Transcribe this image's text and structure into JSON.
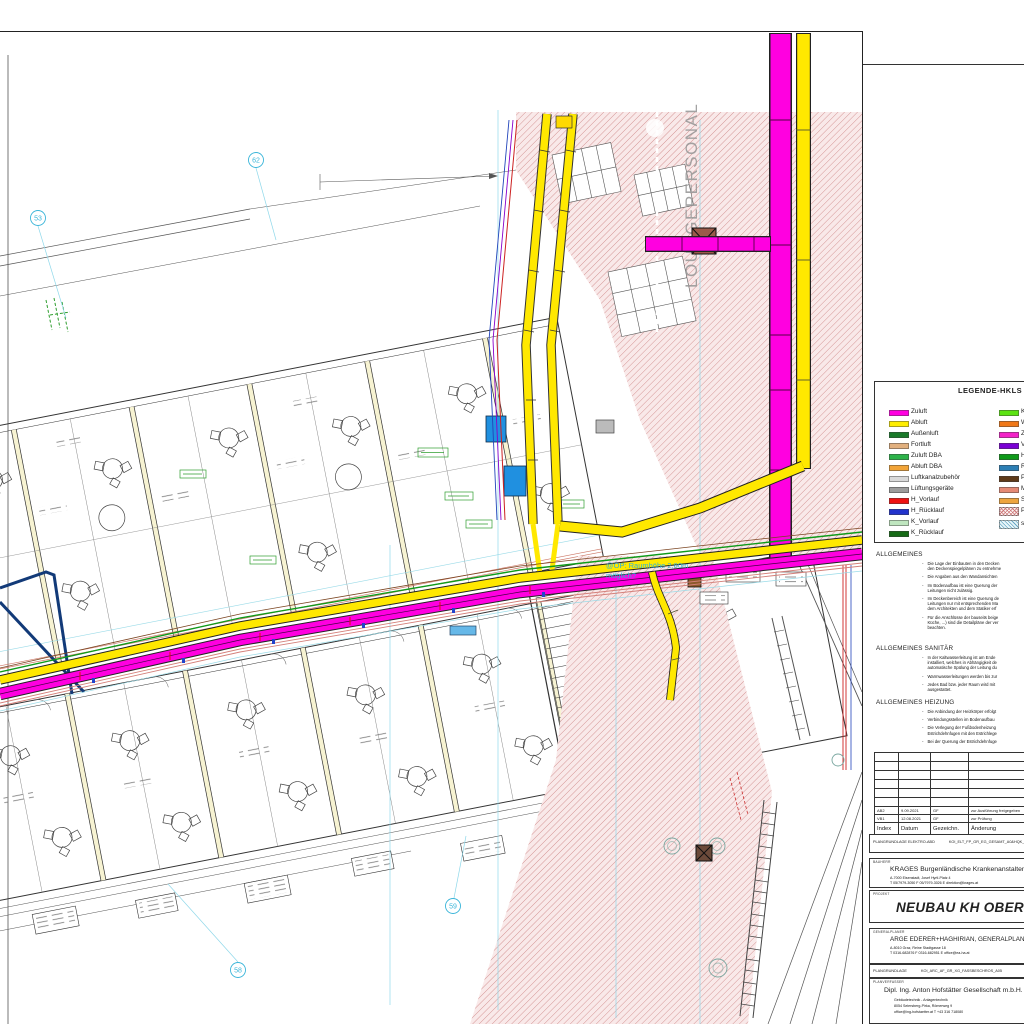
{
  "colors": {
    "zuluft_magenta": "#ff00e0",
    "abluft_yellow": "#ffe800",
    "hatch_pink": "#d29090",
    "grid_cyan": "#3ab5d9",
    "heizung_rot": "#cc2222",
    "ruecklauf_blau": "#2244bb",
    "navy": "#123a78"
  },
  "legend": {
    "title": "LEGENDE-HKLS",
    "left": [
      {
        "label": "Zuluft",
        "color": "#ff00e0"
      },
      {
        "label": "Abluft",
        "color": "#ffee00"
      },
      {
        "label": "Außenluft",
        "color": "#1a7a2a"
      },
      {
        "label": "Fortluft",
        "color": "#e2b07e"
      },
      {
        "label": "Zuluft DBA",
        "color": "#2db34a"
      },
      {
        "label": "Abluft DBA",
        "color": "#f2a438"
      },
      {
        "label": "Luftkanalzubehör",
        "color": "#d9d9d9"
      },
      {
        "label": "Lüftungsgeräte",
        "color": "#9c9c9c"
      },
      {
        "label": "H_Vorlauf",
        "color": "#ee1111"
      },
      {
        "label": "H_Rücklauf",
        "color": "#2233cc"
      },
      {
        "label": "K_Vorlauf",
        "color": "#bfe6bf"
      },
      {
        "label": "K_Rücklauf",
        "color": "#166b16"
      }
    ],
    "right": [
      {
        "label": "K",
        "color": "#5ce312"
      },
      {
        "label": "W",
        "color": "#f07818"
      },
      {
        "label": "Z",
        "color": "#f322c8"
      },
      {
        "label": "V",
        "color": "#7a00d4"
      },
      {
        "label": "H",
        "color": "#0f9a1a"
      },
      {
        "label": "R",
        "color": "#2d7fb5"
      },
      {
        "label": "P",
        "color": "#5f3a18"
      },
      {
        "label": "M",
        "color": "#e58a75"
      },
      {
        "label": "S",
        "color": "#eda53f"
      },
      {
        "label": "P",
        "color": "#fdf3f3",
        "hatch": "pink"
      },
      {
        "label": "s",
        "color": "#e8f6fa",
        "hatch": "blue"
      }
    ]
  },
  "notes": {
    "allgemeines": {
      "title": "ALLGEMEINES",
      "items": [
        "Die Lage der Einbauten in den Decken\nden Deckenspiegelplänen zu entnehme",
        "Die Angaben aus den Wandansichten",
        "Im Bodenaufbau ist eine Querung der\nLeitungen nicht zulässig.",
        "Im Deckenbereich ist eine Querung de\nLeitungen nur mit entsprechenden Ma\ndem Architekten und dem Statiker erf",
        "Für die Anschlüsse der bauseits beige\nKüche, ...) sind die Detailpläne der ver\nbeachten."
      ]
    },
    "sanitaer": {
      "title": "ALLGEMEINES SANITÄR",
      "items": [
        "In der Kaltwasserleitung ist am Ende\ninstalliert, welches in Abhängigkeit de\nautomatische Spülung der Leitung du",
        "Warmwasserleitungen werden bis zur",
        "Jedes Bad bzw. jeder Raum wird mit\nausgestattet."
      ]
    },
    "heizung": {
      "title": "ALLGEMEINES HEIZUNG",
      "items": [
        "Die Anbindung der Heizkörper erfolgt",
        "Verbindungsstellen im Bodenaufbau",
        "Die Verlegung der Fußbodenheizung\nEstrichdehnfugen mit den Estrichlege",
        "Bei der Querung der Estrichdehnfuge"
      ]
    }
  },
  "revisions": {
    "headers": [
      "Index",
      "Datum",
      "Gezeichn.",
      "Änderung"
    ],
    "rows": [
      [
        "AB2",
        "9.09.2021",
        "GF",
        "zur Ausführung freigegeben"
      ],
      [
        "VB1",
        "12.08.2021",
        "GF",
        "zur Prüfung"
      ]
    ]
  },
  "plan_ref_elektro": {
    "label": "PLANGRUNDLAGE ELEKTRO-ABD",
    "file": "KOI_ELT_FP_GR_EG_GESAMT_A0&HQK_"
  },
  "title_block": {
    "bauherr": {
      "label": "BAUHERR",
      "name": "KRAGES Burgenländische Krankenanstalten-Ges",
      "addr": "A-7000 Eisenstadt, Josef Hyrtl-Platz 4",
      "contact": "T 05/7979-3050      F 05/7979-3026      E direktion@krages.at"
    },
    "projekt": {
      "label": "PROJEKT",
      "name": "NEUBAU KH OBERW"
    },
    "generalplaner": {
      "label": "GENERALPLANER",
      "name": "ARGE EDERER+HAGHIRIAN, GENERALPLAN G",
      "addr": "A-8010 Graz, Reine Stadtgasse 18",
      "contact": "T 0316-682876      F 0316-682951      E office@ea-ha.at"
    },
    "plangrundlage": {
      "label": "PLANGRUNDLAGE",
      "file": "KOI_ARC_AF_GR_XG_FASSBESCHROS_A05"
    },
    "planverfasser": {
      "label": "PLANVERFASSER",
      "name": "Dipl. Ing. Anton Hofstätter Gesellschaft m.b.H.",
      "line1": "Gebäudetechnik - Anlagentechnik",
      "line2": "8054 Seiersberg-Pirka, Römerweg 9",
      "line3": "office@ing-hofstaetter.at        T +43 316 718080"
    }
  },
  "plan": {
    "lounge_label": "LOUNGEPERSONAL",
    "op_note_line1": "@OP: Raumhöhe 2,80m",
    "op_note_line2": "möglich?",
    "bubbles": [
      "53",
      "62",
      "58",
      "59"
    ]
  }
}
